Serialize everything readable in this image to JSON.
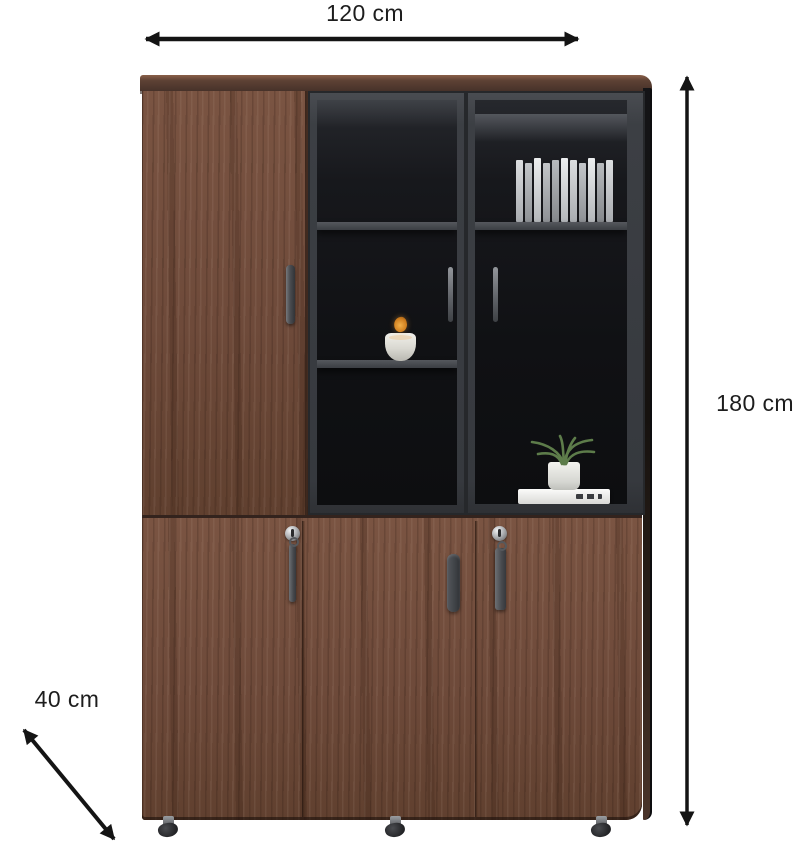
{
  "annotations": {
    "width": {
      "label": "120 cm"
    },
    "height": {
      "label": "180 cm"
    },
    "depth": {
      "label": "40 cm"
    },
    "arrow_color": "#141414",
    "text_color": "#1d1d1d"
  },
  "product": {
    "name": "tall office cabinet with wood doors and glass display doors",
    "background": "#ffffff",
    "colors": {
      "wood": "#6f4b3c",
      "wood_top": "#4a332a",
      "door_frame": "#3c3f44",
      "glass": "#101114",
      "shelf": "#55585d",
      "hardware_silver": "#b0b2b5",
      "hardware_dark": "#47494d",
      "caster": "#222326",
      "decor_white": "#e9e8e4",
      "plant_green": "#5d7c4a",
      "sprig_orange": "#cf7e1e"
    },
    "decor": {
      "middle_glass_item": "white vase with orange sprig",
      "right_glass_top_item": "row of book spines",
      "right_glass_bottom_item": "green potted plant on white books"
    }
  }
}
